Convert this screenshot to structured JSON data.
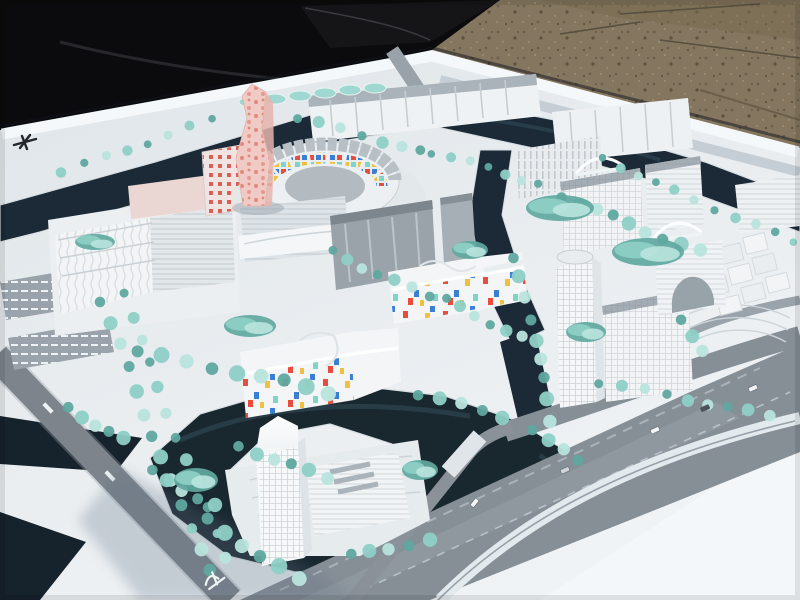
{
  "image": {
    "type": "photograph",
    "subject": "architectural scale model of a waterfront urban master plan district",
    "setting": "white model baseboard photographed outdoors, lying on brown gravel ground with a black tarp at the upper left",
    "visible_text": "none legible; tiny illegible white road-name markings and painted road symbols only"
  },
  "palette": {
    "gravel": "#84765f",
    "gravel_dark": "#6b5e4b",
    "tarp": "#0b0b0d",
    "board": "#e9edf0",
    "board_shade": "#d3dce2",
    "board_bright": "#f3f7fa",
    "water": "#1b2a36",
    "water_deep": "#16222c",
    "road": "#8a9199",
    "road_dark": "#6e757d",
    "tree": "#8ecfc6",
    "tree_dark": "#5fa89f",
    "tree_light": "#b9e4dd",
    "building_white": "#f2f4f5",
    "building_shade": "#dde3e7",
    "roof_gray": "#a5adb4",
    "glass_gray": "#9aa3aa",
    "pink_tower": "#f0cac5",
    "pink_dot": "#e08a7e",
    "confetti_red": "#e74c3c",
    "confetti_blue": "#3b7fd4",
    "confetti_yellow": "#f0c040",
    "confetti_teal": "#7fd4c8"
  },
  "scene": {
    "ground": "gravel ground",
    "tarp": "black tarp / shadow",
    "board": "white model baseboard",
    "perimeter_canal": "dark canal along board edge",
    "central_canal": "canal between centre and east quarter",
    "river": "wide river bend around south island",
    "arena": "oval courtyard building with coloured mosaic inner facade",
    "pink_tower": "twisted pink landmark tower with dot pattern",
    "retail_block_west": "large white retail blocks with ribbed facades",
    "industrial_sheds": "long saw-tooth roofed sheds, north edge",
    "glass_slabs": "grey glass office slabs, centre",
    "confetti_building_center": "white complex with scattered coloured window panels",
    "confetti_building_south": "white school-like block with confetti facade",
    "east_cluster": "white residential blocks across the canal",
    "east_tower": "tall gridded office tower on east island",
    "cube_cluster": "cluster of cubic volumes, north-east",
    "island_tower": "translucent high-rise tower on south island",
    "bridges": "white arched pedestrian bridges",
    "boulevard_west": "tree-lined boulevard with dark roadway",
    "highway_south": "wide boulevard with curved white ramp, south-east",
    "parking": "striped parking lots, west edge"
  },
  "markers": {
    "board_logo": "small dark aircraft-shaped marker printed on white rim",
    "road_symbol": "white painted symbol on roadway near south edge",
    "road_labels": "two tiny illegible white road-name markings"
  },
  "vegetation": {
    "rows": [
      {
        "x1": 100,
        "y1": 300,
        "x2": 208,
        "y2": 572,
        "n": 13,
        "r": 7
      },
      {
        "x1": 122,
        "y1": 292,
        "x2": 224,
        "y2": 556,
        "n": 12,
        "r": 6
      },
      {
        "x1": 66,
        "y1": 408,
        "x2": 126,
        "y2": 440,
        "n": 5,
        "r": 7
      },
      {
        "x1": 152,
        "y1": 472,
        "x2": 216,
        "y2": 506,
        "n": 5,
        "r": 7
      },
      {
        "x1": 214,
        "y1": 120,
        "x2": 60,
        "y2": 172,
        "n": 8,
        "r": 5
      },
      {
        "x1": 300,
        "y1": 118,
        "x2": 420,
        "y2": 152,
        "n": 7,
        "r": 6
      },
      {
        "x1": 432,
        "y1": 152,
        "x2": 540,
        "y2": 184,
        "n": 7,
        "r": 5
      },
      {
        "x1": 560,
        "y1": 196,
        "x2": 700,
        "y2": 252,
        "n": 9,
        "r": 7
      },
      {
        "x1": 600,
        "y1": 158,
        "x2": 792,
        "y2": 242,
        "n": 11,
        "r": 5
      },
      {
        "x1": 332,
        "y1": 252,
        "x2": 428,
        "y2": 296,
        "n": 7,
        "r": 6
      },
      {
        "x1": 448,
        "y1": 300,
        "x2": 520,
        "y2": 338,
        "n": 6,
        "r": 6
      },
      {
        "x1": 516,
        "y1": 258,
        "x2": 552,
        "y2": 420,
        "n": 9,
        "r": 7
      },
      {
        "x1": 600,
        "y1": 382,
        "x2": 772,
        "y2": 416,
        "n": 9,
        "r": 6
      },
      {
        "x1": 680,
        "y1": 318,
        "x2": 700,
        "y2": 352,
        "n": 3,
        "r": 7
      },
      {
        "x1": 236,
        "y1": 446,
        "x2": 330,
        "y2": 478,
        "n": 6,
        "r": 7
      },
      {
        "x1": 206,
        "y1": 520,
        "x2": 300,
        "y2": 580,
        "n": 6,
        "r": 8
      },
      {
        "x1": 352,
        "y1": 556,
        "x2": 430,
        "y2": 540,
        "n": 5,
        "r": 7
      },
      {
        "x1": 140,
        "y1": 352,
        "x2": 330,
        "y2": 392,
        "n": 9,
        "r": 8
      },
      {
        "x1": 420,
        "y1": 394,
        "x2": 500,
        "y2": 416,
        "n": 5,
        "r": 7
      },
      {
        "x1": 532,
        "y1": 428,
        "x2": 576,
        "y2": 462,
        "n": 4,
        "r": 7
      }
    ],
    "blobs": [
      {
        "x": 560,
        "y": 208,
        "rx": 34,
        "ry": 13
      },
      {
        "x": 648,
        "y": 252,
        "rx": 36,
        "ry": 14
      },
      {
        "x": 586,
        "y": 332,
        "rx": 20,
        "ry": 10
      },
      {
        "x": 470,
        "y": 250,
        "rx": 18,
        "ry": 9
      },
      {
        "x": 250,
        "y": 326,
        "rx": 26,
        "ry": 11
      },
      {
        "x": 95,
        "y": 242,
        "rx": 20,
        "ry": 8
      },
      {
        "x": 196,
        "y": 480,
        "rx": 22,
        "ry": 12
      },
      {
        "x": 420,
        "y": 470,
        "rx": 18,
        "ry": 10
      }
    ]
  },
  "cars": [
    {
      "x": 650,
      "y": 430,
      "a": -24,
      "c": "#f2f4f5"
    },
    {
      "x": 700,
      "y": 408,
      "a": -24,
      "c": "#4a525a"
    },
    {
      "x": 748,
      "y": 388,
      "a": -24,
      "c": "#f2f4f5"
    },
    {
      "x": 560,
      "y": 470,
      "a": -24,
      "c": "#cfd6da"
    },
    {
      "x": 470,
      "y": 505,
      "a": -52,
      "c": "#f2f4f5"
    }
  ]
}
